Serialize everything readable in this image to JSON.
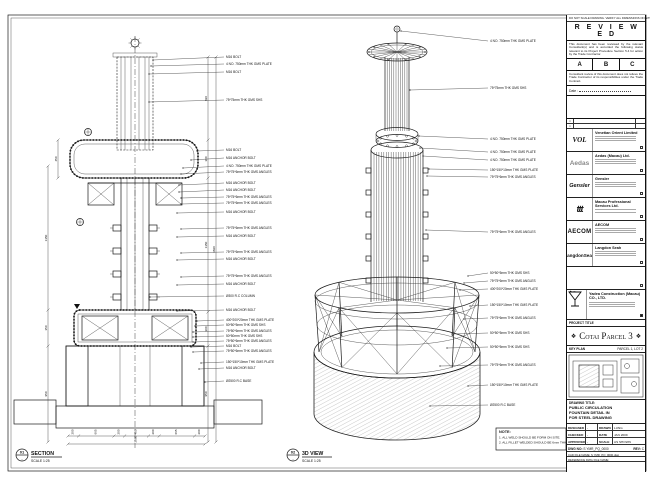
{
  "views": {
    "section": {
      "bubble_no": "01",
      "bubble_ref": "-",
      "title": "SECTION",
      "scale": "SCALE 1:25"
    },
    "view3d": {
      "bubble_no": "02",
      "bubble_ref": "-",
      "title": "3D VIEW",
      "scale": "SCALE 1:25"
    }
  },
  "note": {
    "heading": "NOTE:",
    "lines": [
      "1. ALL WELD SHOULD BE FORM ON SITE.",
      "2. ALL FILLET WELDED SHOULD BE 6mm THK."
    ]
  },
  "section_callouts": [
    "M16 BOLT",
    "4 NO. 750mm THK GMS PLATE",
    "M16 BOLT",
    "75*75mm THK GMS SHS",
    "M16 BOLT",
    "M16 ANCHOR BOLT",
    "4 NO. 750mm THK GMS PLATE",
    "75*75*6mm THK GMS ANGLES",
    "M16 ANCHOR BOLT",
    "M16 ANCHOR BOLT",
    "75*75*6mm THK GMS ANGLES",
    "75*75*6mm THK GMS ANGLES",
    "M16 ANCHOR BOLT",
    "75*75*6mm THK GMS ANGLES",
    "M16 ANCHOR BOLT",
    "75*75*6mm THK GMS ANGLES",
    "M16 ANCHOR BOLT",
    "75*75*6mm THK GMS ANGLES",
    "M16 ANCHOR BOLT",
    "Ø300 R.C COLUMN",
    "M16 ANCHOR BOLT",
    "400*200*20mm THK GMS PLATE",
    "50*50*5mm THK GMS SHS",
    "75*50*6mm THK GMS ANGLES",
    "50*50mm THK GMS SHS",
    "75*50*6mm THK GMS ANGLES",
    "M16 BOLT",
    "75*50*6mm THK GMS ANGLES",
    "150*150*10mm THK GMS PLATE",
    "M16 ANCHOR BOLT",
    "Ø2500 R.C BASE"
  ],
  "view3d_callouts": [
    "4 NO. 750mm THK GMS PLATE",
    "75*75mm THK GMS SHS",
    "4 NO. 750mm THK GMS PLATE",
    "4 NO. 750mm THK GMS PLATE",
    "4 NO. 750mm THK GMS PLATE",
    "150*150*10mm THK GMS PLATE",
    "75*75*6mm THK GMS ANGLES",
    "75*75*6mm THK GMS ANGLES",
    "50*50*5mm THK GMS SHS",
    "75*75*6mm THK GMS ANGLES",
    "400*200*20mm THK GMS PLATE",
    "150*150*10mm THK GMS PLATE",
    "75*75*6mm THK GMS ANGLES",
    "50*50*5mm THK GMS SHS",
    "50*50*5mm THK GMS SHS",
    "75*75*6mm THK GMS ANGLES",
    "150*150*10mm THK GMS PLATE",
    "Ø2500 R.C BASE"
  ],
  "dims": {
    "bottom_chain": [
      "200",
      "665",
      "200",
      "450",
      "200",
      "665",
      "200"
    ],
    "bottom_total": "2580",
    "left_small": "450",
    "left_chain": [
      "1350",
      "350",
      "950"
    ],
    "right_chain": [
      "820",
      "380",
      "1350",
      "300",
      "950"
    ],
    "right_total": "3820"
  },
  "stamp": {
    "top_note": "DO NOT SCALE DRAWING. VERIFY ALL DIMENSIONS ON SITE.",
    "title": "R E V I E W E D",
    "body1": "This document has been reviewed by the relevant Consultant(s) and is accorded the following status relevant to its Project Procedure Section 5.4 for action by the Trade Contractor.",
    "options": [
      "A",
      "B",
      "C"
    ],
    "body2": "Consultant review of this document does not relieve the Trade Contractor of its responsibilities under the Trade Contract.",
    "date_label": "Date :"
  },
  "revisions": [
    {
      "mark": "×",
      "desc": "",
      "by": ""
    },
    {
      "mark": "×",
      "desc": "",
      "by": ""
    }
  ],
  "consultants": [
    {
      "logo": "VOL",
      "name": "Venetian Orient Limited"
    },
    {
      "logo": "Aedas",
      "name": "Aedas (Macau) Ltd."
    },
    {
      "logo": "Gensler",
      "name": "Gensler"
    },
    {
      "logo": "ttt",
      "name": "Macau Professional Services Ltd."
    },
    {
      "logo": "AECOM",
      "name": "AECOM"
    },
    {
      "logo": "LangdonSeah",
      "name": "Langdon Seah"
    }
  ],
  "contractor": {
    "name": "Yadea Construction (Macau) CO., LTD."
  },
  "project": {
    "label": "PROJECT TITLE",
    "name": "Cotai Parcel 3",
    "ornament": "❖"
  },
  "key_plan": {
    "label": "KEY PLAN",
    "note": "PARCEL 1, LOT 2"
  },
  "drawing_title": {
    "label": "DRAWING TITLE:",
    "lines": [
      "PUBLIC CIRCULATION",
      "FOUNTAIN DETAIL IN",
      "FOR STEEL DRAWING"
    ]
  },
  "approvals": {
    "rows": [
      {
        "l": "DESIGNED",
        "lv": "-",
        "r": "DRAWN",
        "rv": "LUNG"
      },
      {
        "l": "CHECKED",
        "lv": "-",
        "r": "DATE",
        "rv": "JAN 2009"
      },
      {
        "l": "APPROVED",
        "lv": "-",
        "r": "SCALE",
        "rv": "AS SHOWN"
      }
    ],
    "dwg_label": "DWG NO:",
    "dwg_no": "S YMR_PQ_0000",
    "rev_label": "REV:",
    "rev": "C",
    "cad_line1": "CAD FILE NAME: S YMR_PQ_0000.dwg",
    "cad_line2": "REFERENCE DWG FILE NAME:"
  }
}
